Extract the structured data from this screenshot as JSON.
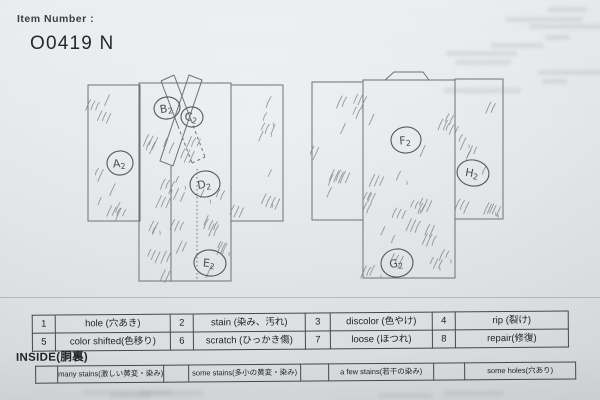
{
  "header": {
    "item_number_label": "Item Number :",
    "item_number_value": "O0419 N"
  },
  "diagrams": {
    "front": {
      "markers": [
        {
          "text": "A2",
          "cx": 120,
          "cy": 163,
          "rx": 13,
          "ry": 12,
          "rot": -5
        },
        {
          "text": "B2",
          "cx": 167,
          "cy": 108,
          "rx": 13,
          "ry": 11,
          "rot": -10
        },
        {
          "text": "C2",
          "cx": 192,
          "cy": 117,
          "rx": 11,
          "ry": 10,
          "rot": 8
        },
        {
          "text": "D2",
          "cx": 205,
          "cy": 184,
          "rx": 15,
          "ry": 13,
          "rot": -8
        },
        {
          "text": "E2",
          "cx": 210,
          "cy": 263,
          "rx": 16,
          "ry": 13,
          "rot": 5
        }
      ]
    },
    "back": {
      "markers": [
        {
          "text": "F2",
          "cx": 406,
          "cy": 140,
          "rx": 15,
          "ry": 13,
          "rot": -5
        },
        {
          "text": "H2",
          "cx": 473,
          "cy": 173,
          "rx": 16,
          "ry": 13,
          "rot": 10
        },
        {
          "text": "G2",
          "cx": 397,
          "cy": 263,
          "rx": 16,
          "ry": 14,
          "rot": -8
        }
      ]
    }
  },
  "legend": {
    "cells": [
      {
        "num": "1",
        "label": "hole (穴あき)"
      },
      {
        "num": "2",
        "label": "stain (染み、汚れ)"
      },
      {
        "num": "3",
        "label": "discolor (色やけ)"
      },
      {
        "num": "4",
        "label": "rip (裂け)"
      },
      {
        "num": "5",
        "label": "color shifted(色移り)"
      },
      {
        "num": "6",
        "label": "scratch (ひっかき傷)"
      },
      {
        "num": "7",
        "label": "loose (ほつれ)"
      },
      {
        "num": "8",
        "label": "repair(修復)"
      }
    ]
  },
  "inside": {
    "title": "INSIDE(胴裏)",
    "options": [
      {
        "label": "many stains(激しい黄変・染み)"
      },
      {
        "label": "some stains(多小の黄変・染み)"
      },
      {
        "label": "a few stains(若干の染み)"
      },
      {
        "label": "some holes(穴あり)"
      }
    ]
  },
  "colors": {
    "paper": "#e7e9eb",
    "ink": "#1d1f21",
    "outline": "#6e7276",
    "pencil": "#7e8387",
    "marker": "#54585c",
    "border": "#45484b"
  }
}
